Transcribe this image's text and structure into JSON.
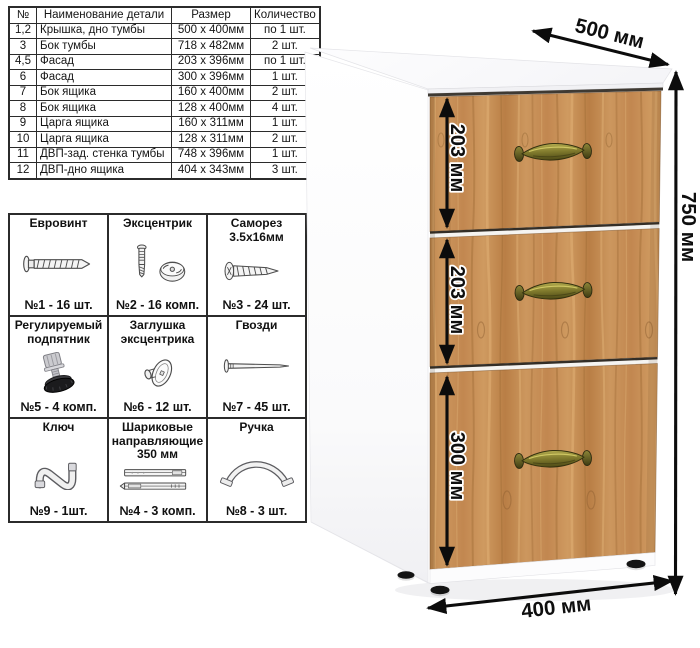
{
  "parts_table": {
    "headers": [
      "№",
      "Наименование детали",
      "Размер",
      "Количество"
    ],
    "rows": [
      [
        "1,2",
        "Крышка, дно тумбы",
        "500 х 400мм",
        "по 1 шт."
      ],
      [
        "3",
        "Бок тумбы",
        "718 х 482мм",
        "2 шт."
      ],
      [
        "4,5",
        "Фасад",
        "203 х 396мм",
        "по 1 шт."
      ],
      [
        "6",
        "Фасад",
        "300 х 396мм",
        "1 шт."
      ],
      [
        "7",
        "Бок ящика",
        "160 х 400мм",
        "2 шт."
      ],
      [
        "8",
        "Бок ящика",
        "128 х 400мм",
        "4 шт."
      ],
      [
        "9",
        "Царга ящика",
        "160 х 311мм",
        "1 шт."
      ],
      [
        "10",
        "Царга ящика",
        "128 х 311мм",
        "2 шт."
      ],
      [
        "11",
        "ДВП-зад. стенка тумбы",
        "748 х 396мм",
        "1 шт."
      ],
      [
        "12",
        "ДВП-дно ящика",
        "404 х 343мм",
        "3 шт."
      ]
    ]
  },
  "hardware_table": {
    "cells": [
      {
        "title": "Евровинт",
        "icon": "euro-screw-icon",
        "count": "№1 - 16 шт."
      },
      {
        "title": "Эксцентрик",
        "icon": "cam-lock-icon",
        "count": "№2 - 16 комп."
      },
      {
        "title": "Саморез 3.5х16мм",
        "icon": "self-tapping-screw-icon",
        "count": "№3 - 24 шт."
      },
      {
        "title": "Регулируемый подпятник",
        "icon": "adjustable-foot-icon",
        "count": "№5 - 4 комп."
      },
      {
        "title": "Заглушка эксцентрика",
        "icon": "cam-cover-icon",
        "count": "№6 - 12 шт."
      },
      {
        "title": "Гвозди",
        "icon": "nail-icon",
        "count": "№7 - 45 шт."
      },
      {
        "title": "Ключ",
        "icon": "hex-key-icon",
        "count": "№9 - 1шт."
      },
      {
        "title": "Шариковые направляющие 350 мм",
        "icon": "drawer-slides-icon",
        "count": "№4 - 3 комп."
      },
      {
        "title": "Ручка",
        "icon": "handle-icon",
        "count": "№8 - 3 шт."
      }
    ]
  },
  "cabinet": {
    "drawer_count": 3,
    "dimensions": {
      "depth": "500 мм",
      "height": "750 мм",
      "width": "400 мм",
      "drawer_top": "203 мм",
      "drawer_middle": "203 мм",
      "drawer_bottom": "300 мм"
    },
    "colors": {
      "wood": "#c28750",
      "carcass": "#ffffff",
      "handle_bronze": "#7f792c",
      "dimension_lines": "#0c0c0c",
      "feet": "#141414"
    }
  }
}
